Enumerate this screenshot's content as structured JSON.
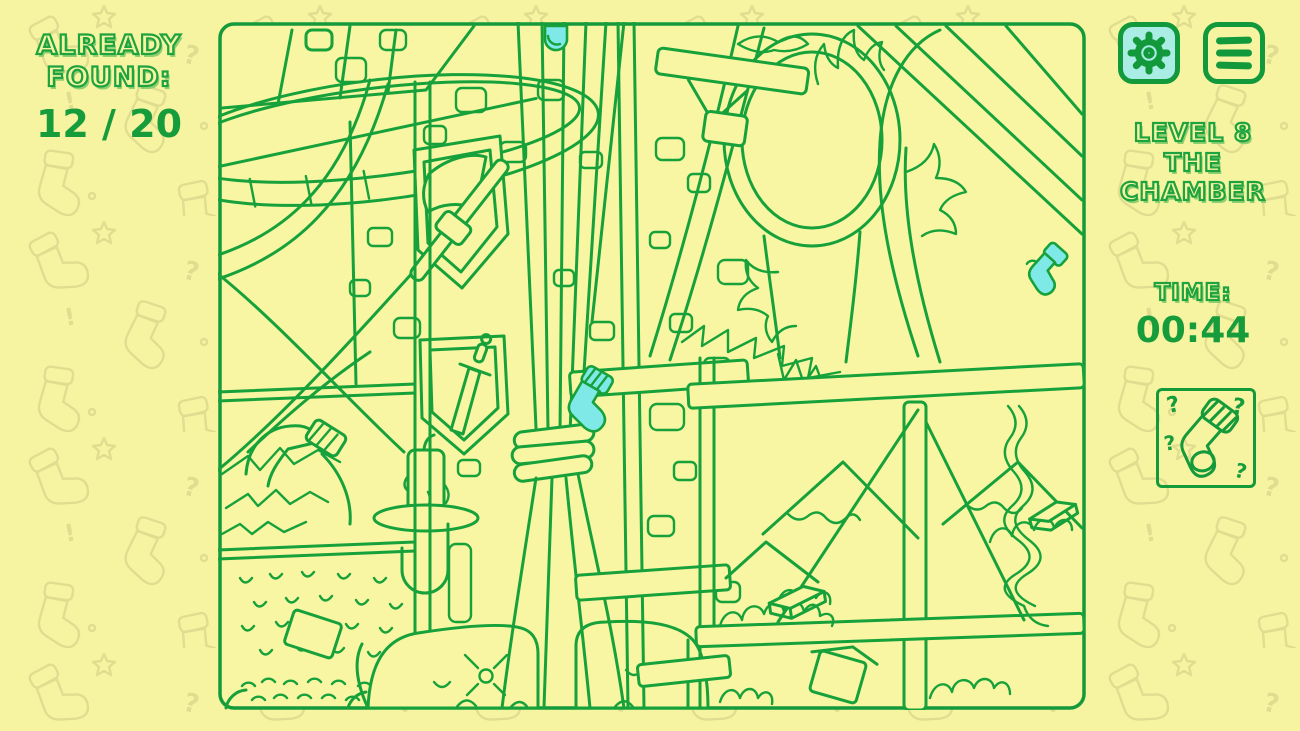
{
  "colors": {
    "background": "#f7f4a1",
    "line_green": "#17a13b",
    "ui_green": "#12993c",
    "highlight_cyan": "#7fe9e8",
    "settings_button_bg": "#a9ede4",
    "pattern_stroke": "#e0dd90"
  },
  "left_panel": {
    "found_label_line1": "ALREADY",
    "found_label_line2": "FOUND:",
    "found_value": "12 / 20"
  },
  "right_panel": {
    "settings_button": {
      "icon": "gear-icon"
    },
    "menu_button": {
      "icon": "menu-icon"
    },
    "level_line1": "LEVEL 8",
    "level_line2": "THE",
    "level_line3": "CHAMBER",
    "time_label": "TIME:",
    "time_value": "00:44",
    "hint_box": {
      "icon": "mystery-sock-icon",
      "marks": [
        "?",
        "?",
        "?",
        "?"
      ]
    }
  },
  "scene": {
    "name": "the-chamber-hidden-object-scene",
    "found_socks_highlighted": 3,
    "highlight_color": "#7fe9e8"
  }
}
